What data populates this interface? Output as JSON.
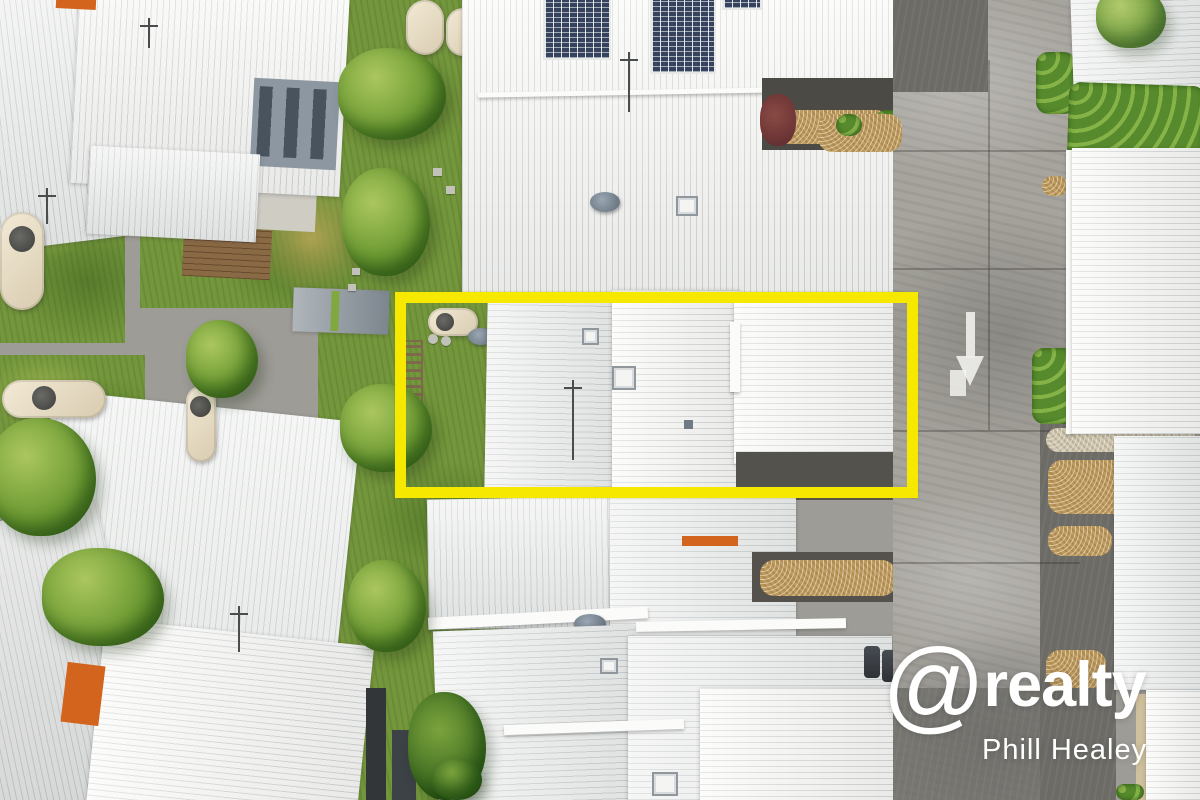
{
  "scene": {
    "type": "aerial-photograph",
    "subject": "residential townhouse complex with white metal roofs, gardens and internal road"
  },
  "watermark": {
    "at_symbol": "@",
    "brand_name": "realty",
    "agent_name": "Phill Healey"
  },
  "highlight": {
    "color": "#f7e800"
  },
  "road_marking": {
    "type": "arrow-down"
  },
  "theme": {
    "roof_white": "#edefed",
    "roof_bright": "#f9f9f6",
    "lawn_green": "#74963c",
    "road_grey": "#a7a49e",
    "asphalt_grey": "#6c6b66",
    "gravel_tan": "#bd9a5e",
    "accent_orange": "#d2641e",
    "solar_navy": "#36435f",
    "watermark_white": "#ffffff"
  }
}
